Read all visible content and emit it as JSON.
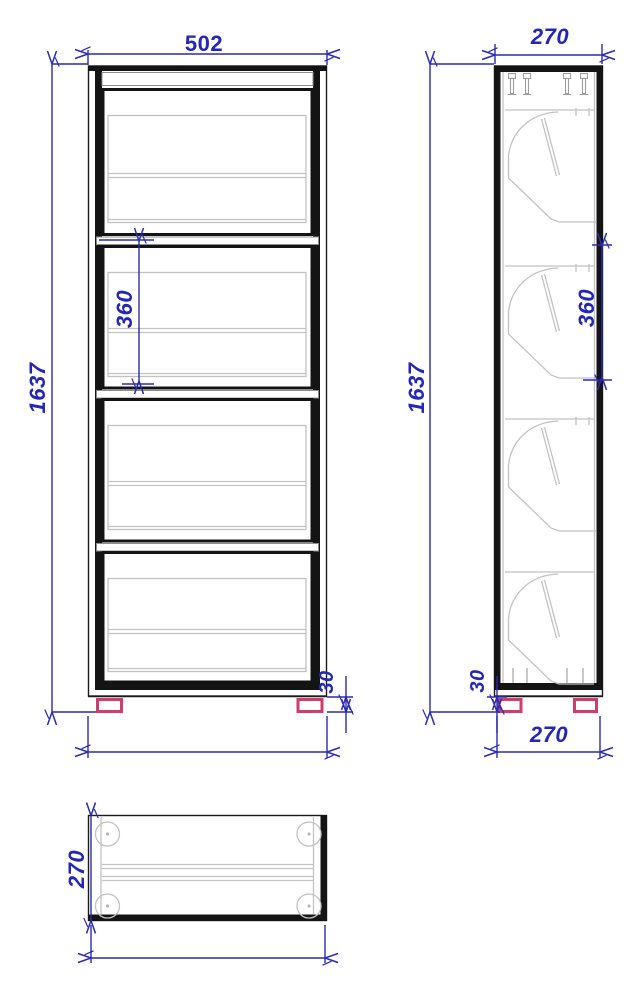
{
  "drawing": {
    "type": "furniture-technical-drawing",
    "subject": "shoe cabinet with four tilt-out compartments, three orthographic views"
  },
  "colors": {
    "dimension_blue": "#2a2ab4",
    "structure_black": "#141414",
    "detail_gray": "#c2c2c2",
    "feet_pink": "#d23c6c",
    "background": "#ffffff"
  },
  "views": {
    "front": {
      "width": "502",
      "height": "1637",
      "compartment_pitch": "360",
      "feet_height": "30"
    },
    "side": {
      "depth_top": "270",
      "height": "1637",
      "compartment_pitch": "360",
      "feet_height": "30",
      "depth_bottom": "270"
    },
    "top": {
      "depth": "270"
    }
  }
}
